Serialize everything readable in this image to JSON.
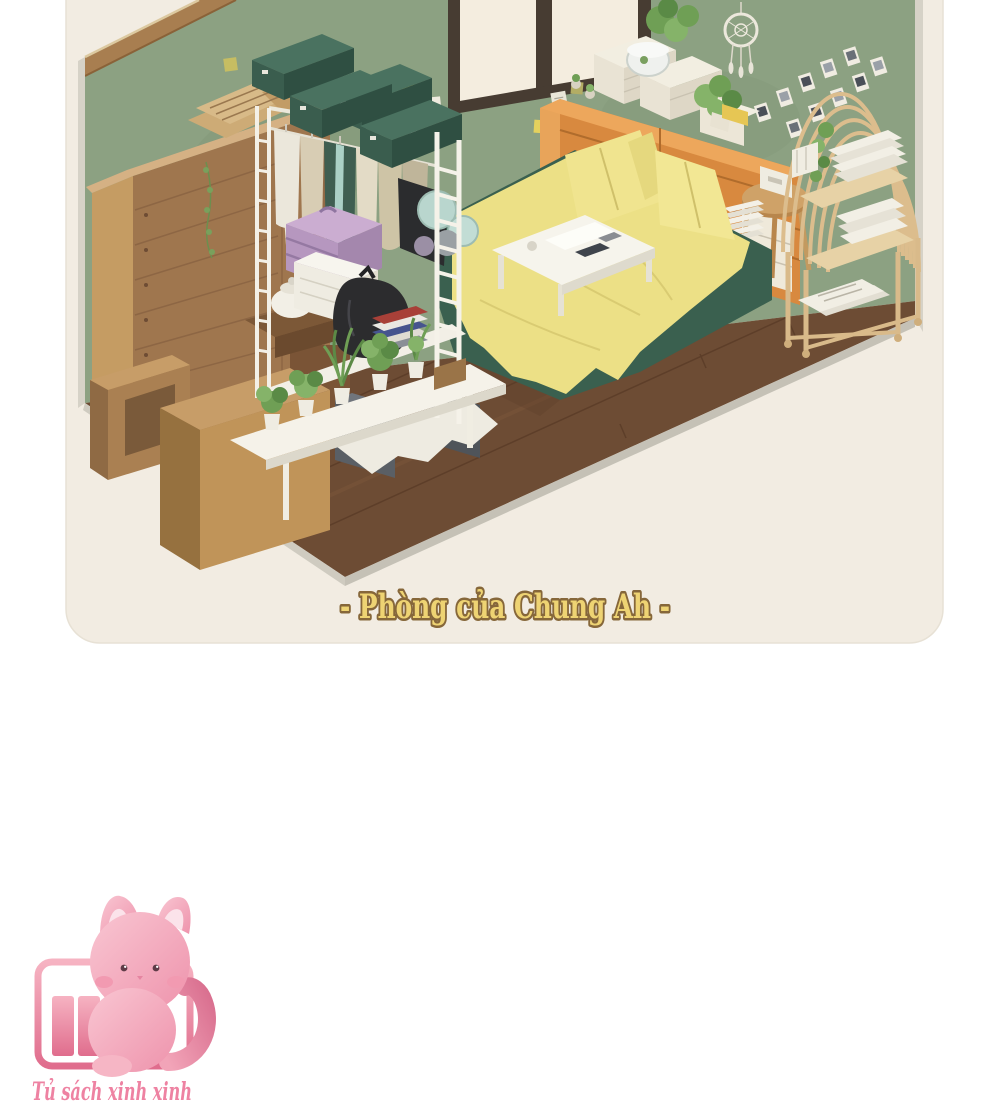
{
  "page": {
    "background": "#ffffff"
  },
  "card": {
    "background": "#f2ece2",
    "caption": "- Phòng của Chung Ah -",
    "caption_fill": "#eed373",
    "caption_outline": "#86673a"
  },
  "room": {
    "wall": "#8ca182",
    "wall_trim": "#a87e50",
    "wall_edge": "#d6d2c7",
    "floor": "#6d4c34",
    "floor_edge": "#cfcbc0",
    "window_pane": "#f4eddf",
    "window_frame": "#473c32",
    "bed_base": "#3a604f",
    "bed_sheet": "#ece086",
    "pillow": "#f0e48f",
    "dresser": "#d8893f",
    "box_lid": "#4a7260",
    "box_front": "#3a5d4e",
    "suitcase": "#b697bf",
    "rattan": "#dcbd8d",
    "wood_light": "#c09459",
    "wood_dark": "#9f764e",
    "plant_green": "#6f9f55"
  },
  "mascot": {
    "label": "Tủ sách xinh xinh",
    "label_color": "#ee82a2",
    "pink_light": "#f9c6d2",
    "pink_dark": "#ee93ac",
    "icon": "bookshelf-icon"
  }
}
